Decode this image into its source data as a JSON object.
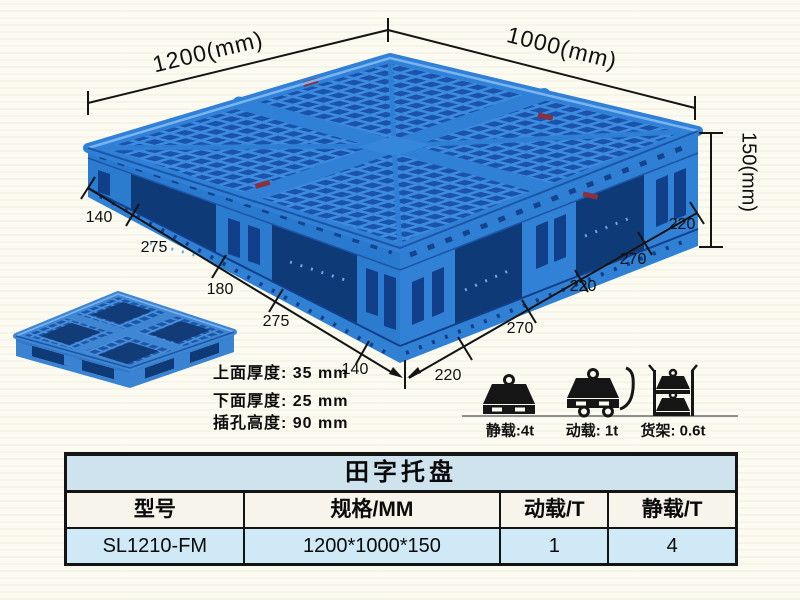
{
  "annotations": {
    "width_label": "1200(mm)",
    "depth_label": "1000(mm)",
    "height_label": "150(mm)",
    "left_edge_segments": [
      "140",
      "275",
      "180",
      "275",
      "140"
    ],
    "right_edge_segments": [
      "220",
      "270",
      "220",
      "270",
      "220"
    ]
  },
  "specs": {
    "lines": [
      "上面厚度: 35 mm",
      "下面厚度: 25 mm",
      "插孔高度: 90 mm"
    ]
  },
  "load_ratings": [
    {
      "name": "static-load",
      "label": "静载:4t"
    },
    {
      "name": "dynamic-load",
      "label": "动载: 1t"
    },
    {
      "name": "rack-load",
      "label": "货架: 0.6t"
    }
  ],
  "table": {
    "title": "田字托盘",
    "headers": [
      "型号",
      "规格/MM",
      "动载/T",
      "静载/T"
    ],
    "rows": [
      [
        "SL1210-FM",
        "1200*1000*150",
        "1",
        "4"
      ]
    ]
  },
  "colors": {
    "pallet_primary": "#2e7fd6",
    "pallet_dark": "#1a53ac",
    "pallet_shadow": "#0f3a78",
    "table_title_bg": "#cfe3ef",
    "table_header_bg": "#f7f4ec",
    "table_data_bg": "#cfe9f6"
  }
}
